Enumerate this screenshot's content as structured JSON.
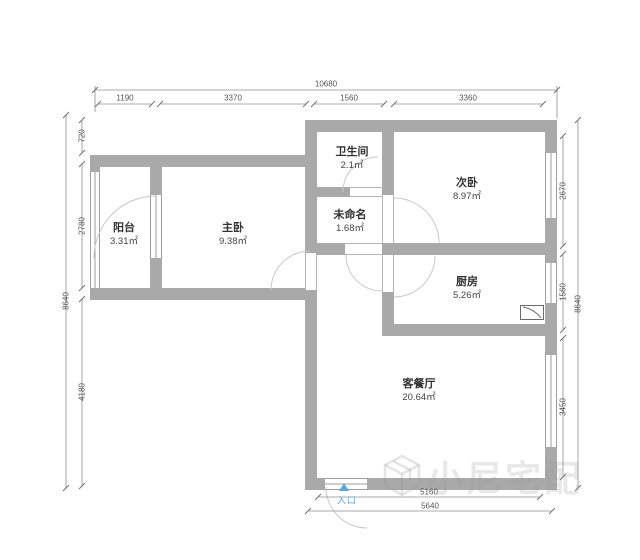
{
  "plan": {
    "rooms": [
      {
        "name": "阳台",
        "area": "3.31㎡"
      },
      {
        "name": "主卧",
        "area": "9.38㎡"
      },
      {
        "name": "卫生间",
        "area": "2.1㎡"
      },
      {
        "name": "未命名",
        "area": "1.68㎡"
      },
      {
        "name": "次卧",
        "area": "8.97㎡"
      },
      {
        "name": "厨房",
        "area": "5.26㎡"
      },
      {
        "name": "客餐厅",
        "area": "20.64㎡"
      }
    ],
    "entrance_label": "入口",
    "watermark_text": "小尼宅配",
    "colors": {
      "wall": "#a9a9a9",
      "entrance_blue": "#58a8dc",
      "dimension_text": "#555555",
      "room_text": "#333333",
      "door_arc": "#c8c8c8"
    }
  },
  "dimensions": {
    "top_total": "10680",
    "top_segments": [
      "1190",
      "3370",
      "1560",
      "3360"
    ],
    "left_total": "8640",
    "left_segments": [
      "720",
      "2780",
      "4180"
    ],
    "right_total": "8640",
    "right_segments": [
      "2670",
      "1560",
      "3450"
    ],
    "bottom_inner": "5160",
    "bottom_outer": "5640"
  }
}
